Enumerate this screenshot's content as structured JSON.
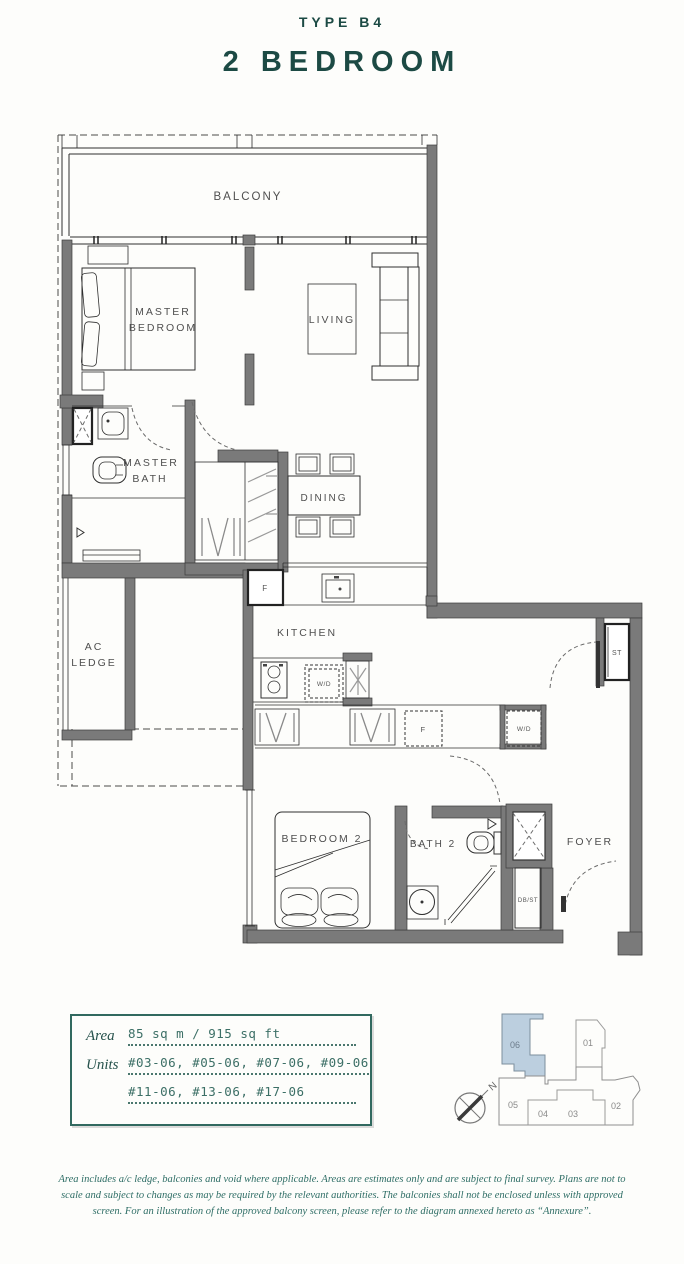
{
  "header": {
    "type_label": "TYPE B4",
    "title": "2 BEDROOM"
  },
  "floorplan": {
    "rooms": {
      "balcony": "BALCONY",
      "master_bedroom_l1": "MASTER",
      "master_bedroom_l2": "BEDROOM",
      "living": "LIVING",
      "master_bath_l1": "MASTER",
      "master_bath_l2": "BATH",
      "dining": "DINING",
      "ac_ledge_l1": "AC",
      "ac_ledge_l2": "LEDGE",
      "kitchen": "KITCHEN",
      "bedroom2": "BEDROOM 2",
      "bath2": "BATH 2",
      "foyer": "FOYER"
    },
    "fixtures": {
      "fridge": "F",
      "washer_dryer": "W/D",
      "store": "ST",
      "db_store": "DB/ST"
    }
  },
  "info_box": {
    "area_label": "Area",
    "area_value": "85 sq m / 915 sq ft",
    "units_label": "Units",
    "units_line1": "#03-06, #05-06, #07-06, #09-06",
    "units_line2": "#11-06, #13-06, #17-06"
  },
  "keyplan": {
    "north_label": "N",
    "highlighted_unit": "06",
    "unit_01": "01",
    "unit_02": "02",
    "unit_03": "03",
    "unit_04": "04",
    "unit_05": "05",
    "unit_06": "06"
  },
  "disclaimer": "Area includes a/c ledge, balconies and void where applicable. Areas are estimates only and are subject to final survey. Plans are not to scale and subject to changes as may be required by the relevant authorities. The balconies shall not be enclosed unless with approved screen. For an illustration of the approved balcony screen, please refer to the diagram annexed hereto as “Annexure”.",
  "colors": {
    "accent_teal": "#1c4a44",
    "info_teal": "#31695f",
    "wall_gray": "#7a7a7a",
    "keyplan_highlight": "#bccfdf"
  }
}
